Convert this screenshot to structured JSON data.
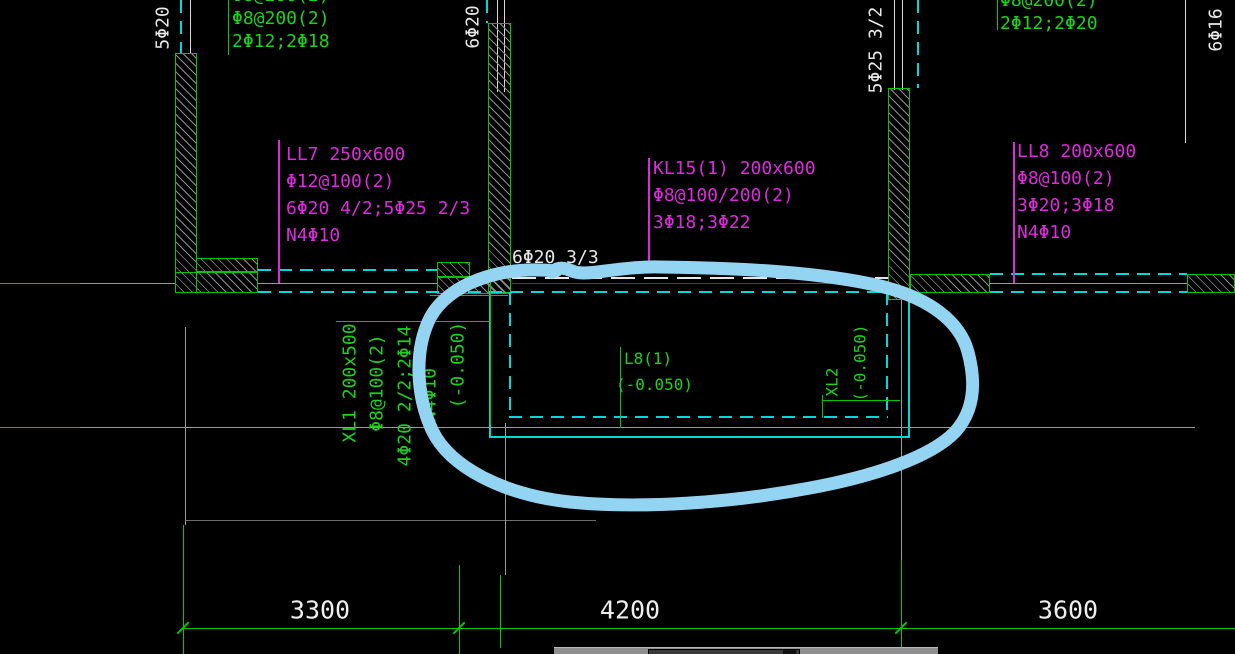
{
  "title": "structural-cad-plan-fragment",
  "colors": {
    "background": "#000000",
    "line_green": "#00c800",
    "text_magenta": "#dd2add",
    "line_cyan": "#00d9d9",
    "text_white": "#e8e8e8",
    "grid_gray": "#9b9b9b",
    "highlight_blue": "#93d4f2"
  },
  "beam_annotations": {
    "top_left_wall": {
      "partial_top_line": "Φ8@200(2)",
      "line1": "Φ8@200(2)",
      "line2": "2Φ12;2Φ18"
    },
    "top_right_wall": {
      "partial_top_line": "Φ8@200(2)",
      "line1": "2Φ12;2Φ20"
    },
    "ll7": {
      "line1": "LL7 250x600",
      "line2": "Φ12@100(2)",
      "line3": "6Φ20 4/2;5Φ25 2/3",
      "line4": "N4Φ10"
    },
    "kl15": {
      "line1": "KL15(1) 200x600",
      "line2": "Φ8@100/200(2)",
      "line3": "3Φ18;3Φ22"
    },
    "ll8": {
      "line1": "LL8 200x600",
      "line2": "Φ8@100(2)",
      "line3": "3Φ20;3Φ18",
      "line4": "N4Φ10"
    }
  },
  "rebar_callouts": {
    "col_a": "5Φ20",
    "col_b": "6Φ20",
    "beam_mid": "6Φ20 3/3",
    "col_c": "5Φ25 3/2",
    "col_d": "6Φ16"
  },
  "pit": {
    "l8_line1": "L8(1)",
    "l8_line2": "(-0.050)",
    "xl2_line1": "XL2",
    "xl2_line2": "(-0.050)",
    "xl1_col1": "XL1 200x500",
    "xl1_col2": "Φ8@100(2)",
    "xl1_col3": "4Φ20 2/2;2Φ14",
    "xl1_col4": "N4Φ10",
    "xl1_col5": "(-0.050)"
  },
  "dimensions": {
    "d1": "3300",
    "d2": "4200",
    "d3": "3600"
  }
}
